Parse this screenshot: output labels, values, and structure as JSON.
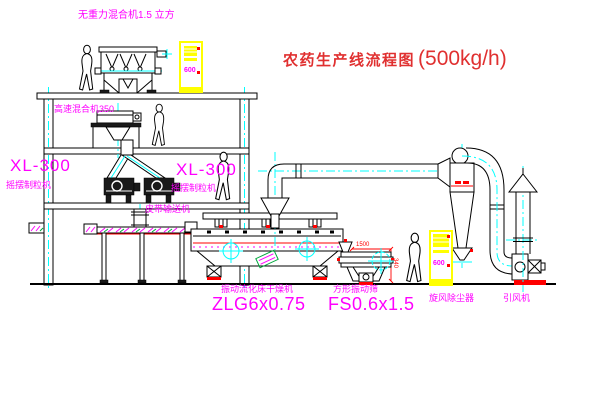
{
  "title": {
    "name_zh": "农药生产线流程图",
    "capacity": "(500kg/h)"
  },
  "equipment_labels": {
    "gravity_mixer": "无重力混合机1.5 立方",
    "high_speed_mixer": "高速混合机350",
    "granulator_left": {
      "model": "XL-300",
      "name": "摇摆制粒机"
    },
    "granulator_right": {
      "model": "XL-300",
      "name": "摇摆制粒机"
    },
    "belt_conveyor": "皮带输送机",
    "dryer": {
      "name": "振动流化床干燥机",
      "model": "ZLG6x0.75"
    },
    "sieve": {
      "name": "方形振动筛",
      "model": "FS0.6x1.5"
    },
    "cyclone": "旋风除尘器",
    "induced_draft_fan": "引风机"
  },
  "dimension_annotations": {
    "sieve_width": "1500",
    "sieve_height": "340"
  },
  "control_cabinets": {
    "top_panel_text": "600",
    "bottom_panel_text": "600"
  },
  "colors": {
    "label_magenta": "#ff00ff",
    "title_red": "#e03030",
    "dimension_red": "#ff0000",
    "cabinet_yellow": "#ffff00",
    "centerline_cyan": "#00ffff",
    "hatch_green": "#00a83c",
    "outline_black": "#000000"
  }
}
